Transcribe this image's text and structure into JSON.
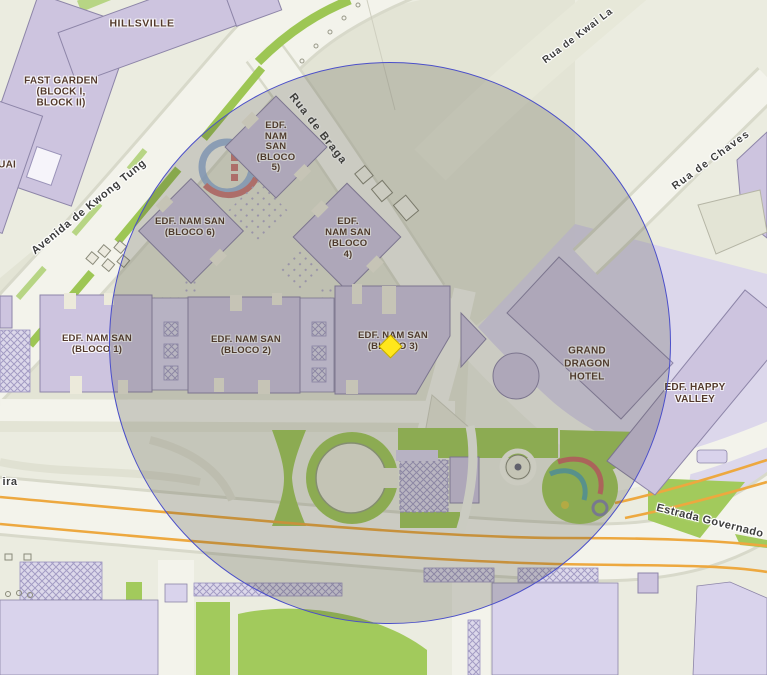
{
  "streets": {
    "avenida_de_kwong_tung": "Avenida de Kwong Tung",
    "rua_de_braga": "Rua de Braga",
    "rua_de_kwai_la": "Rua de Kwai La",
    "rua_de_chaves": "Rua de Chaves",
    "estrada_governado": "Estrada Governado",
    "ira_partial": "ira"
  },
  "buildings": {
    "hillsville": "HILLSVILLE",
    "fast_garden": "FAST GARDEN\n(BLOCK I,\nBLOCK II)",
    "uai_partial": "UAI",
    "nam_san_5": "EDF.\nNAM\nSAN\n(BLOCO\n5)",
    "nam_san_6": "EDF. NAM SAN\n(BLOCO 6)",
    "nam_san_4": "EDF.\nNAM SAN\n(BLOCO\n4)",
    "nam_san_1": "EDF. NAM SAN\n(BLOCO 1)",
    "nam_san_2": "EDF. NAM SAN\n(BLOCO 2)",
    "nam_san_3": "EDF. NAM SAN\n(BLOCO 3)",
    "grand_dragon_hotel": "GRAND\nDRAGON\nHOTEL",
    "happy_valley": "EDF. HAPPY\nVALLEY"
  },
  "colors": {
    "bg": "#ebece0",
    "ground": "#e3e4d5",
    "road": "#f3f3eb",
    "building": "#cdc4df",
    "building_light": "#d9d3ec",
    "building_stroke": "#8d85a8",
    "green": "#a2ca5c",
    "orange": "#eda83f",
    "label": "#53392c",
    "street": "#3d3d3d",
    "circle_stroke": "#4b4fc9",
    "circle_fill": "rgba(66,66,50,0.22)",
    "marker": "#ffe71c"
  }
}
